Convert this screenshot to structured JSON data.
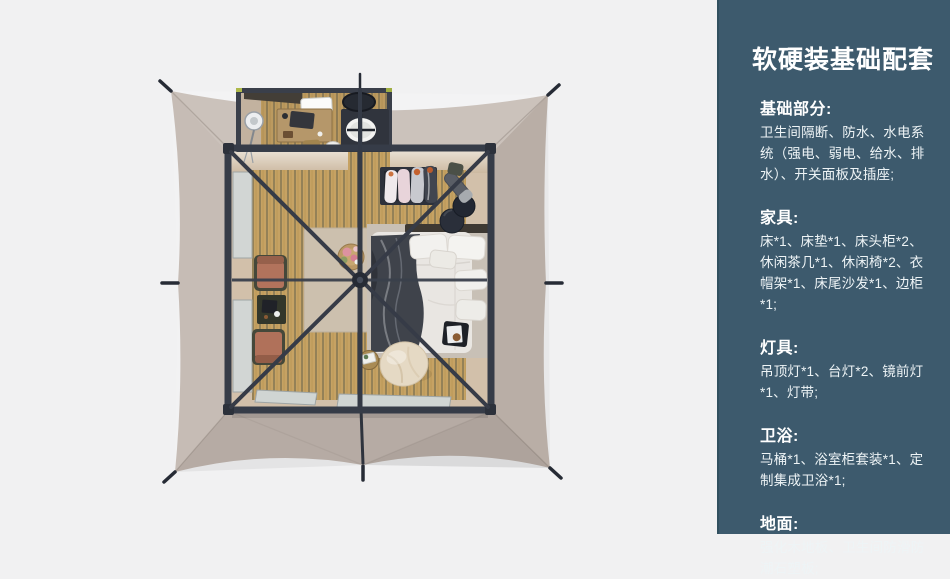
{
  "panel": {
    "title": "软硬装基础配套",
    "sections": [
      {
        "heading": "基础部分:",
        "body": "卫生间隔断、防水、水电系统（强电、弱电、给水、排水）、开关面板及插座;"
      },
      {
        "heading": "家具:",
        "body": "床*1、床垫*1、床头柜*2、休闲茶几*1、休闲椅*2、衣帽架*1、床尾沙发*1、边柜*1;"
      },
      {
        "heading": "灯具:",
        "body": "吊顶灯*1、台灯*2、镜前灯*1、灯带;"
      },
      {
        "heading": "卫浴:",
        "body": "马桶*1、浴室柜套装*1、定制集成卫浴*1;"
      },
      {
        "heading": "地面:",
        "body": "强化木地板、卫生间防滑防潮石塑板;"
      }
    ],
    "colors": {
      "background": "#3d5a6d",
      "text": "#eef4f6",
      "heading": "#ffffff"
    }
  },
  "scene": {
    "type": "3d-top-down-render",
    "subject": "safari-tent-guest-room-floorplan",
    "items": [
      "tent-canvas",
      "roof-frame",
      "bathroom",
      "bed",
      "nightstand-poufs",
      "clothes-rack",
      "lounge-chairs",
      "side-table",
      "flower-table",
      "bean-bag",
      "tray-table",
      "windows",
      "wood-floor",
      "rug"
    ],
    "colors": {
      "page_bg": "#f1f1f2",
      "canvas": "#c0b5ad",
      "frame": "#363c48",
      "wood": "#c6a263",
      "wood_stripe": "#8b7b55",
      "wall_beige": "#d2c0aa",
      "window": "#d0d5d3",
      "rug": "#ccc0ae",
      "duvet": "#e9e6e2",
      "throw_blanket": "#3f434b",
      "chair": "#b2735c",
      "bean_bag": "#e5d9c4"
    }
  }
}
